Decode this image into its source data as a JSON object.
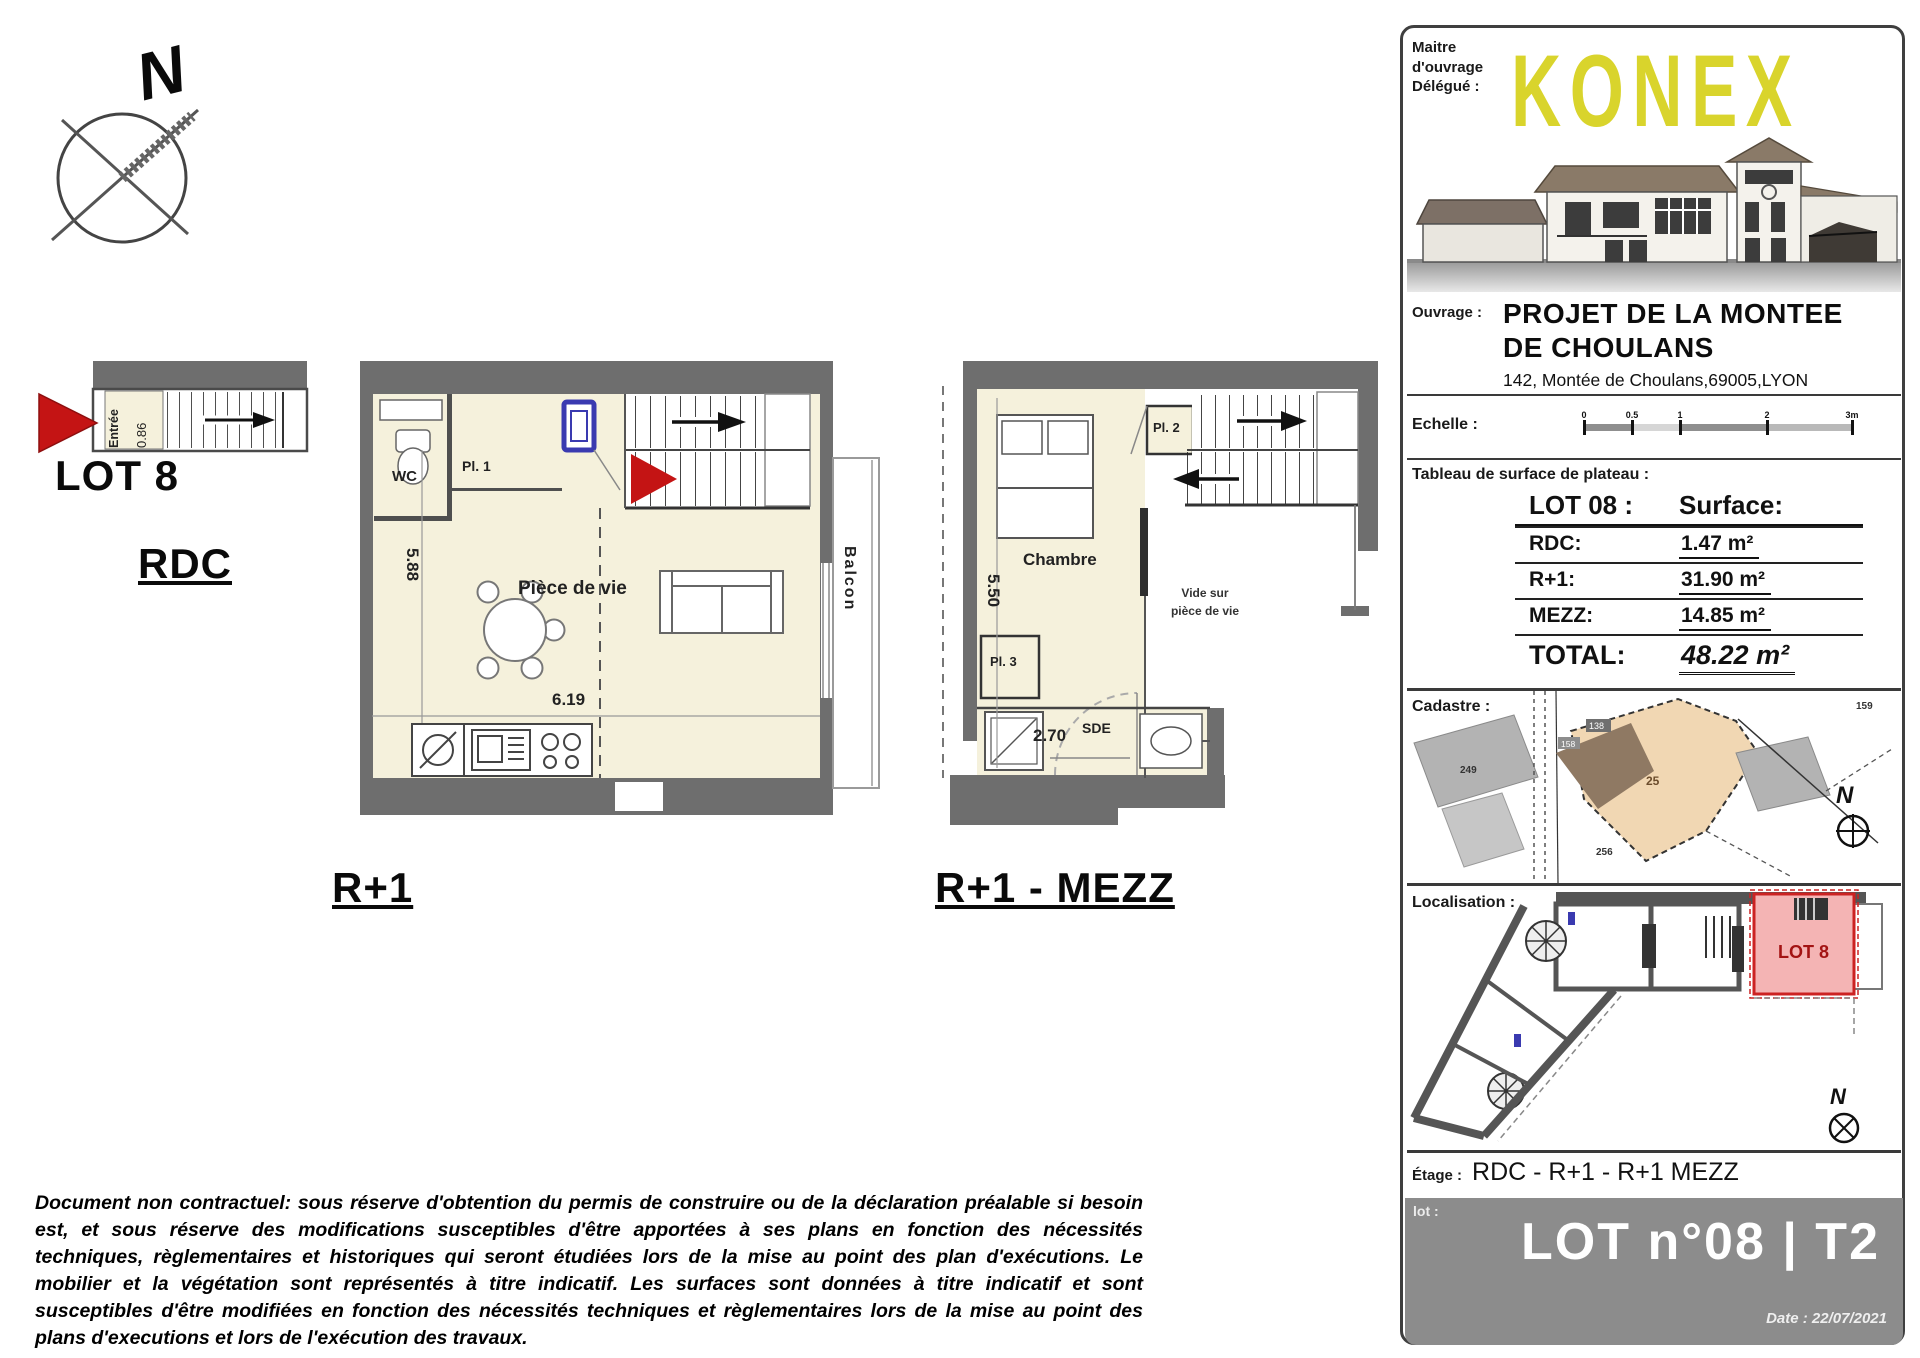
{
  "compass": {
    "north": "N"
  },
  "plans": {
    "rdc": {
      "lot_label": "LOT 8",
      "floor_label": "RDC",
      "entry_label": "Entrée",
      "entry_dim": "0.86"
    },
    "r1": {
      "floor_label": "R+1",
      "wc": "WC",
      "closet1": "Pl. 1",
      "living": "Pièce de vie",
      "balcony": "Balcon",
      "dim_h": "5.88",
      "dim_w": "6.19"
    },
    "mezz": {
      "floor_label": "R+1 - MEZZ",
      "bedroom": "Chambre",
      "closet2": "Pl. 2",
      "closet3": "Pl. 3",
      "shower": "SDE",
      "void_line1": "Vide sur",
      "void_line2": "pièce de vie",
      "dim_h": "5.50",
      "dim_w": "2.70"
    }
  },
  "title_block": {
    "maitre_label": "Maitre\nd'ouvrage\nDélégué :",
    "logo_text": "KONEX",
    "ouvrage_label": "Ouvrage :",
    "project_title_line1": "PROJET DE LA MONTEE",
    "project_title_line2": "DE CHOULANS",
    "address": "142, Montée de Choulans,69005,LYON",
    "echelle_label": "Echelle :",
    "scale_ticks": [
      "0",
      "0.5",
      "1",
      "2",
      "3m"
    ],
    "tableau_label": "Tableau de surface de plateau :",
    "surface_table": {
      "header_lot": "LOT 08 :",
      "header_surface": "Surface:",
      "rows": [
        {
          "label": "RDC:",
          "value": "1.47 m²"
        },
        {
          "label": "R+1:",
          "value": "31.90 m²"
        },
        {
          "label": "MEZZ:",
          "value": "14.85 m²"
        }
      ],
      "total_label": "TOTAL:",
      "total_value": "48.22 m²"
    },
    "cadastre_label": "Cadastre :",
    "cadastre_parcels": {
      "p25": "25",
      "p249": "249",
      "p256": "256",
      "p159": "159",
      "p138": "138",
      "p158": "158"
    },
    "localisation_label": "Localisation :",
    "localisation_lot": "LOT 8",
    "etage_label": "Étage :",
    "etage_value": "RDC - R+1 - R+1 MEZZ",
    "footer": {
      "lot_label": "lot :",
      "lot_title": "LOT n°08 | T2",
      "date_label": "Date :",
      "date_value": "22/07/2021"
    }
  },
  "disclaimer": "Document non contractuel: sous réserve d'obtention du permis de construire ou de la déclaration préalable si besoin est, et sous réserve des modifications susceptibles d'être apportées à ses plans en fonction des nécessités techniques, règlementaires et historiques qui seront étudiées lors de la mise au point des plan d'exécutions. Le mobilier et la végétation sont représentés à titre indicatif. Les surfaces sont données à titre indicatif et sont susceptibles d'être modifiées en fonction des nécessités techniques et règlementaires lors de la mise au point des plans d'executions et lors de l'exécution des travaux."
}
